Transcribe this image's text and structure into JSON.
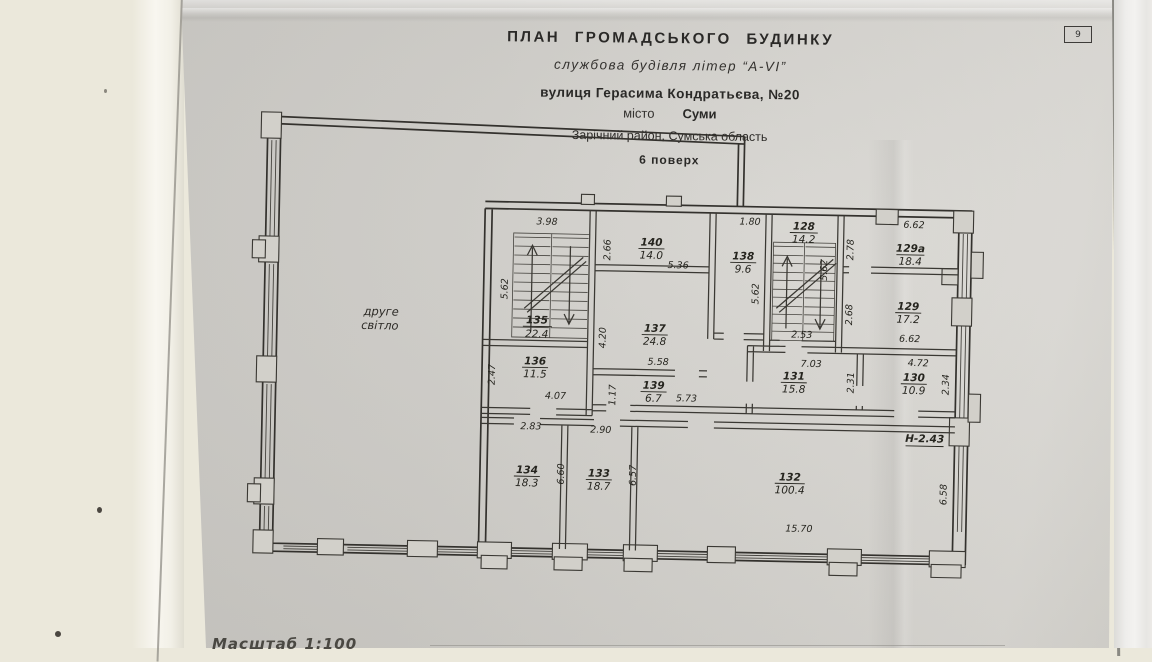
{
  "page": {
    "number": "9"
  },
  "title_block": {
    "line1": "ПЛАН  ГРОМАДСЬКОГО  БУДИНКУ",
    "line2": "службова будівля літер “А-VI”",
    "line3": "вулиця  Герасима Кондратьєва, №20",
    "line4_label": "місто",
    "line4_value": "Суми",
    "line5": "Зарічний район, Сумська область",
    "line6": "6 поверх"
  },
  "footer": {
    "scale": "Масштаб   1:100"
  },
  "plan": {
    "hall_label_line1": "друге",
    "hall_label_line2": "світло",
    "height_note": "Н-2.43",
    "rooms": [
      {
        "number": "135",
        "area": "22.4"
      },
      {
        "number": "140",
        "area": "14.0"
      },
      {
        "number": "138",
        "area": "9.6"
      },
      {
        "number": "128",
        "area": "14.2"
      },
      {
        "number": "129а",
        "area": "18.4"
      },
      {
        "number": "129",
        "area": "17.2"
      },
      {
        "number": "137",
        "area": "24.8"
      },
      {
        "number": "136",
        "area": "11.5"
      },
      {
        "number": "139",
        "area": "6.7"
      },
      {
        "number": "131",
        "area": "15.8"
      },
      {
        "number": "130",
        "area": "10.9"
      },
      {
        "number": "134",
        "area": "18.3"
      },
      {
        "number": "133",
        "area": "18.7"
      },
      {
        "number": "132",
        "area": "100.4"
      }
    ],
    "dims": [
      "3.98",
      "5.62",
      "2.66",
      "5.36",
      "1.80",
      "5.62",
      "5.62",
      "2.53",
      "2.78",
      "6.62",
      "2.68",
      "6.62",
      "4.20",
      "5.58",
      "1.17",
      "5.73",
      "7.03",
      "2.31",
      "4.72",
      "2.34",
      "2.47",
      "4.07",
      "2.83",
      "2.90",
      "6.60",
      "6.57",
      "15.70",
      "6.58"
    ]
  },
  "colors": {
    "paper": "#cbc9c4",
    "background": "#ebe8db",
    "ink": "#33312d"
  }
}
